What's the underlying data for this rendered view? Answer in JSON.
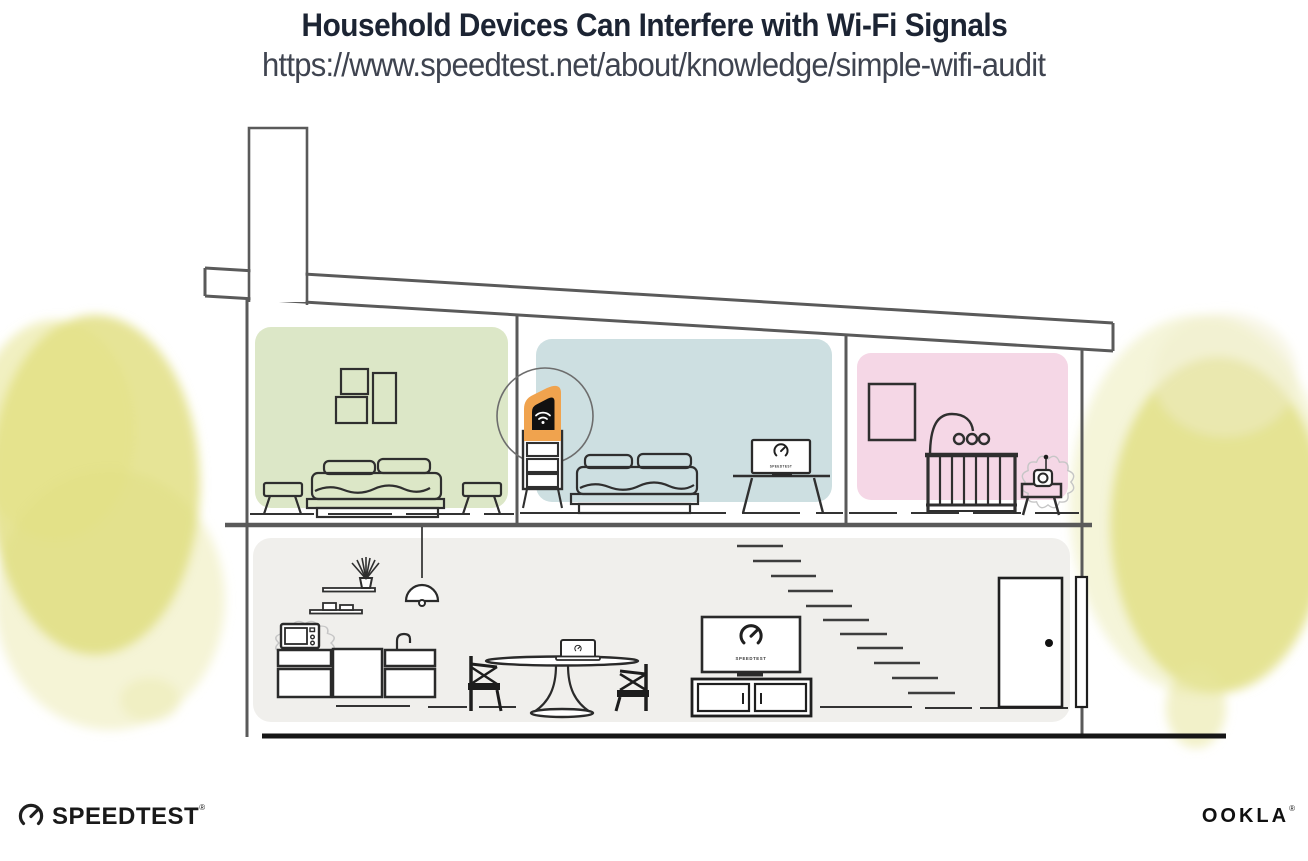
{
  "header": {
    "title": "Household Devices Can Interfere with Wi-Fi Signals",
    "url": "https://www.speedtest.net/about/knowledge/simple-wifi-audit"
  },
  "illustration": {
    "rooms": [
      {
        "name": "bedroom-green",
        "color": "#dce7c7"
      },
      {
        "name": "bedroom-blue",
        "color": "#cddfe1"
      },
      {
        "name": "nursery-pink",
        "color": "#f5d7e6"
      },
      {
        "name": "living-kitchen-gray",
        "color": "#f0efec"
      }
    ],
    "devices": {
      "wifi_router": {
        "name": "wifi-router",
        "highlight_color": "#f0a34e",
        "highlighted": true
      },
      "bedroom_tv": {
        "name": "bedroom-tv",
        "screen_label": "SPEEDTEST"
      },
      "living_room_tv": {
        "name": "living-room-tv",
        "screen_label": "SPEEDTEST"
      },
      "laptop": {
        "name": "laptop-on-dining-table"
      },
      "microwave": {
        "name": "microwave",
        "interference": true
      },
      "baby_monitor": {
        "name": "baby-monitor",
        "interference": true
      }
    },
    "foliage_color": "#dfdd78",
    "accent_orange": "#f0a34e"
  },
  "footer": {
    "speedtest_wordmark": "SPEEDTEST",
    "speedtest_reg": "®",
    "ookla_wordmark": "OOKLA",
    "ookla_reg": "®"
  }
}
